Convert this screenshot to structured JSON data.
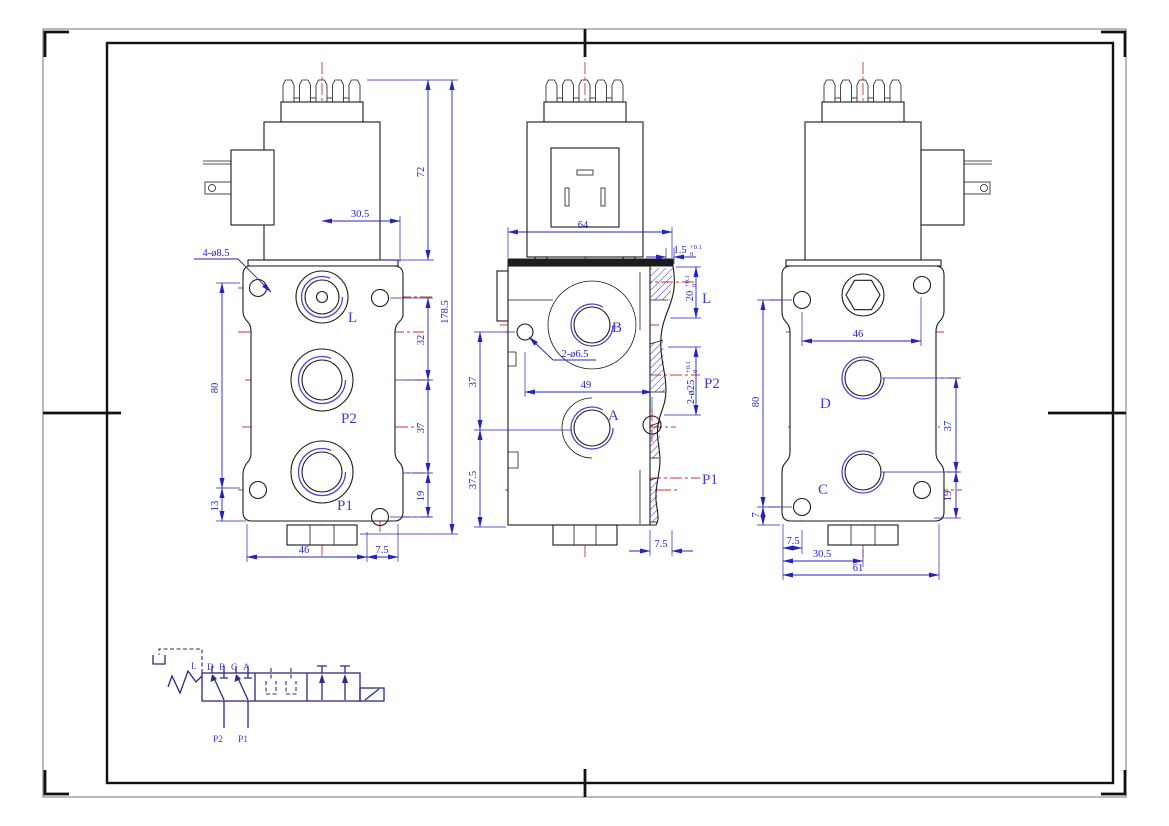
{
  "drawing": {
    "title": "solenoid-valve-three-view-drawing",
    "colors": {
      "line": "#1a1a1a",
      "dimension": "#2424ba",
      "centerline": "#d03030",
      "hatch": "#3b3bd0",
      "port_label": "#3d3dcc"
    },
    "front": {
      "port_l": "L",
      "port_p2": "P2",
      "port_p1": "P1",
      "dim_coil_h": "72",
      "dim_offset": "30.5",
      "dim_total_h": "178.5",
      "callout_holes": "4-ø8.5",
      "dim_left_h": "80",
      "dim_13": "13",
      "dim_32": "32",
      "dim_37": "37",
      "dim_19": "19",
      "dim_46": "46",
      "dim_7_5": "7.5"
    },
    "side": {
      "port_b": "B",
      "port_a": "A",
      "sec_l": "L",
      "sec_p2": "P2",
      "sec_p1": "P1",
      "dim_coil_w": "64",
      "callout_holes": "2-ø6.5",
      "dim_49": "49",
      "dim_37": "37",
      "dim_37_5": "37.5",
      "dim_7_5": "7.5",
      "dim_1_5": "1.5",
      "dim_20": "20",
      "dim_bore": "2-ø25",
      "tol_up": "+0.1",
      "tol_dn": "0"
    },
    "rear": {
      "port_d": "D",
      "port_c": "C",
      "dim_46": "46",
      "dim_80": "80",
      "dim_7": "7",
      "dim_37": "37",
      "dim_19": "19",
      "dim_7_5": "7.5",
      "dim_30_5": "30.5",
      "dim_61": "61"
    },
    "schematic": {
      "drain": "L",
      "top_ports": [
        "D",
        "B",
        "C",
        "A"
      ],
      "p2": "P2",
      "p1": "P1"
    }
  }
}
